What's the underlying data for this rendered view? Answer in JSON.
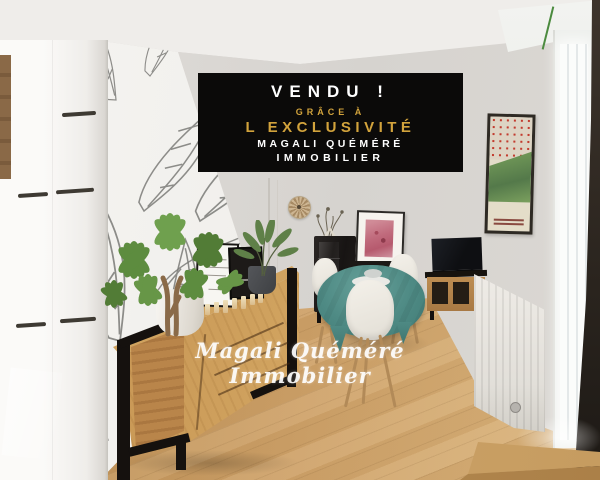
{
  "banner": {
    "line1": "VENDU !",
    "line2": "GRÂCE À",
    "line3": "L EXCLUSIVITÉ",
    "line4": "MAGALI QUÉMÉRÉ",
    "line5": "IMMOBILIER",
    "colors": {
      "background": "#0b0a09",
      "gold": "#d2a33c",
      "text": "#ffffff"
    }
  },
  "watermark": {
    "text": "Magali Quéméré Immobilier",
    "color": "#ffffff"
  },
  "scene": {
    "type": "real-estate interior photo",
    "room": "living-dining room with wood floor",
    "colors": {
      "floor_wood": "#c79a60",
      "tablecloth_teal": "#4e8a84",
      "wall_white": "#dbd8d4",
      "furniture_oak": "#c48f4f",
      "metal_frame_black": "#15110e",
      "plant_green": "#5d8c3f"
    },
    "objects": [
      "botanical-wallpaper",
      "white-cabinet",
      "oak-sideboard",
      "money-tree-plant",
      "schefflera-plant",
      "candles",
      "framed-prints",
      "wall-clock",
      "display-cabinet",
      "pink-artwork",
      "dining-table-teal-cloth",
      "white-shell-chairs",
      "tv",
      "media-stand",
      "radiator",
      "vintage-poster",
      "window",
      "wood-step"
    ]
  }
}
